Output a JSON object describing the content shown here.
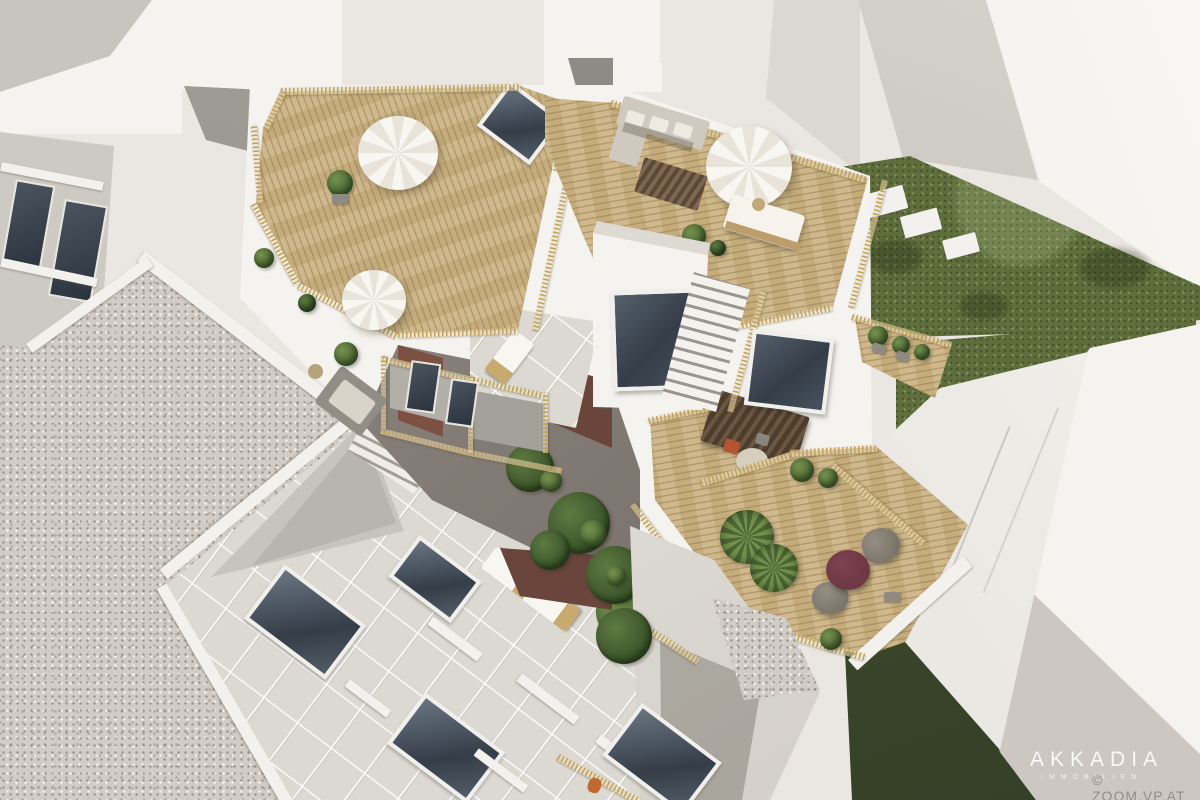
{
  "meta": {
    "kind": "3d-architectural-aerial-render",
    "subject": "residential building complex with wooden rooftop terraces, inner courtyard and gardens"
  },
  "watermark": {
    "brand": "AKKADIA",
    "subtitle": "IMMOBILIEN",
    "credit": "© ZOOM.VP.AT"
  },
  "palette": {
    "wall-bright": "#f5f3ef",
    "wall-light": "#eae7e2",
    "wall-shade": "#cdc9c3",
    "glass-dark": "#343d48",
    "glass-frame": "#f1efeb",
    "deck-wood": "#cab383",
    "railing-gold": "#bfa25e",
    "lawn-green": "#5f6e3c",
    "lawn-shadow": "#3c4a2b",
    "gravel-gray": "#d1ccc6",
    "brick-red": "#7c5042",
    "brick-dark": "#6a453c",
    "roof-tile": "#dcd9d3",
    "plant-green": "#4c6636",
    "plant-light": "#74904c",
    "furniture-white": "#f8f6f1",
    "furniture-gray": "#8f8b84",
    "table-burgundy": "#6d3743",
    "parapet-white": "#f3f1ed"
  }
}
